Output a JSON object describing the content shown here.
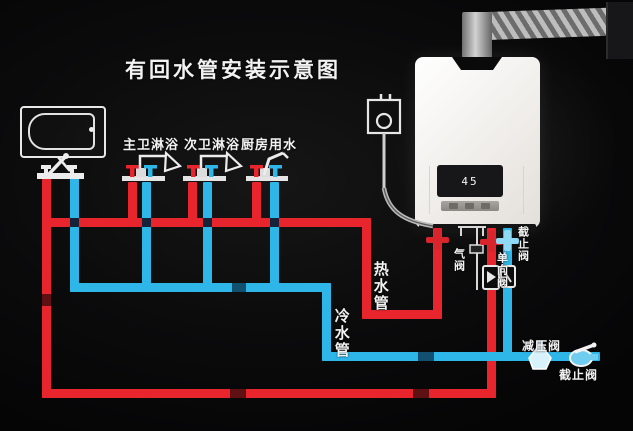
{
  "title": "有回水管安装示意图",
  "colors": {
    "hot_water": "#e8252d",
    "cold_water": "#2eb6e9",
    "background": "#0a0a0b",
    "line_art": "#ececec"
  },
  "fixtures": [
    {
      "label": "主卫淋浴",
      "type": "shower"
    },
    {
      "label": "次卫淋浴",
      "type": "shower"
    },
    {
      "label": "厨房用水",
      "type": "kitchen-tap"
    }
  ],
  "pipe_labels": {
    "hot": "热水管",
    "cold": "冷水管"
  },
  "valve_labels": {
    "gas": "气阀",
    "check": "单向阀",
    "stop_heater_inlet": "截止阀",
    "pressure_reducing": "减压阀",
    "stop_cold_main": "截止阀"
  },
  "heater": {
    "display": "45"
  }
}
